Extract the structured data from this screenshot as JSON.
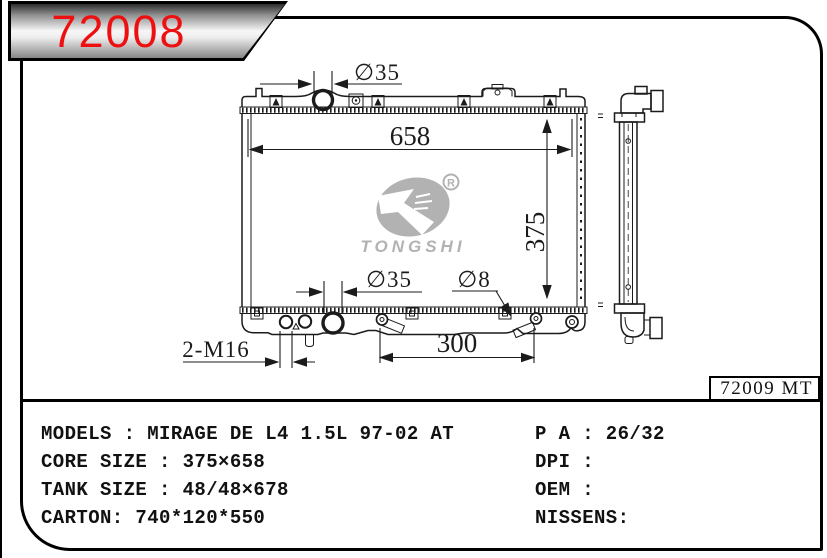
{
  "colors": {
    "accent_red": "#ee1010",
    "line_black": "#1b1b1b",
    "watermark_gray": "#a8a8a8"
  },
  "banner": {
    "part_number": "72008"
  },
  "watermark": {
    "brand": "TONGSHI",
    "registered_mark": "R"
  },
  "drawing": {
    "ref_code": "72009 MT",
    "dim_top_neck": "∅35",
    "dim_core_width": "658",
    "dim_core_height": "375",
    "dim_bottom_neck": "∅35",
    "dim_pipe": "∅8",
    "dim_pipe_span": "300",
    "dim_drain": "2-M16"
  },
  "specs": {
    "left": [
      "MODELS : MIRAGE DE L4 1.5L 97-02 AT",
      "CORE SIZE : 375×658",
      "TANK SIZE : 48/48×678",
      "CARTON: 740*120*550"
    ],
    "right": [
      "P A : 26/32",
      "DPI :",
      "OEM :",
      "NISSENS:"
    ]
  }
}
